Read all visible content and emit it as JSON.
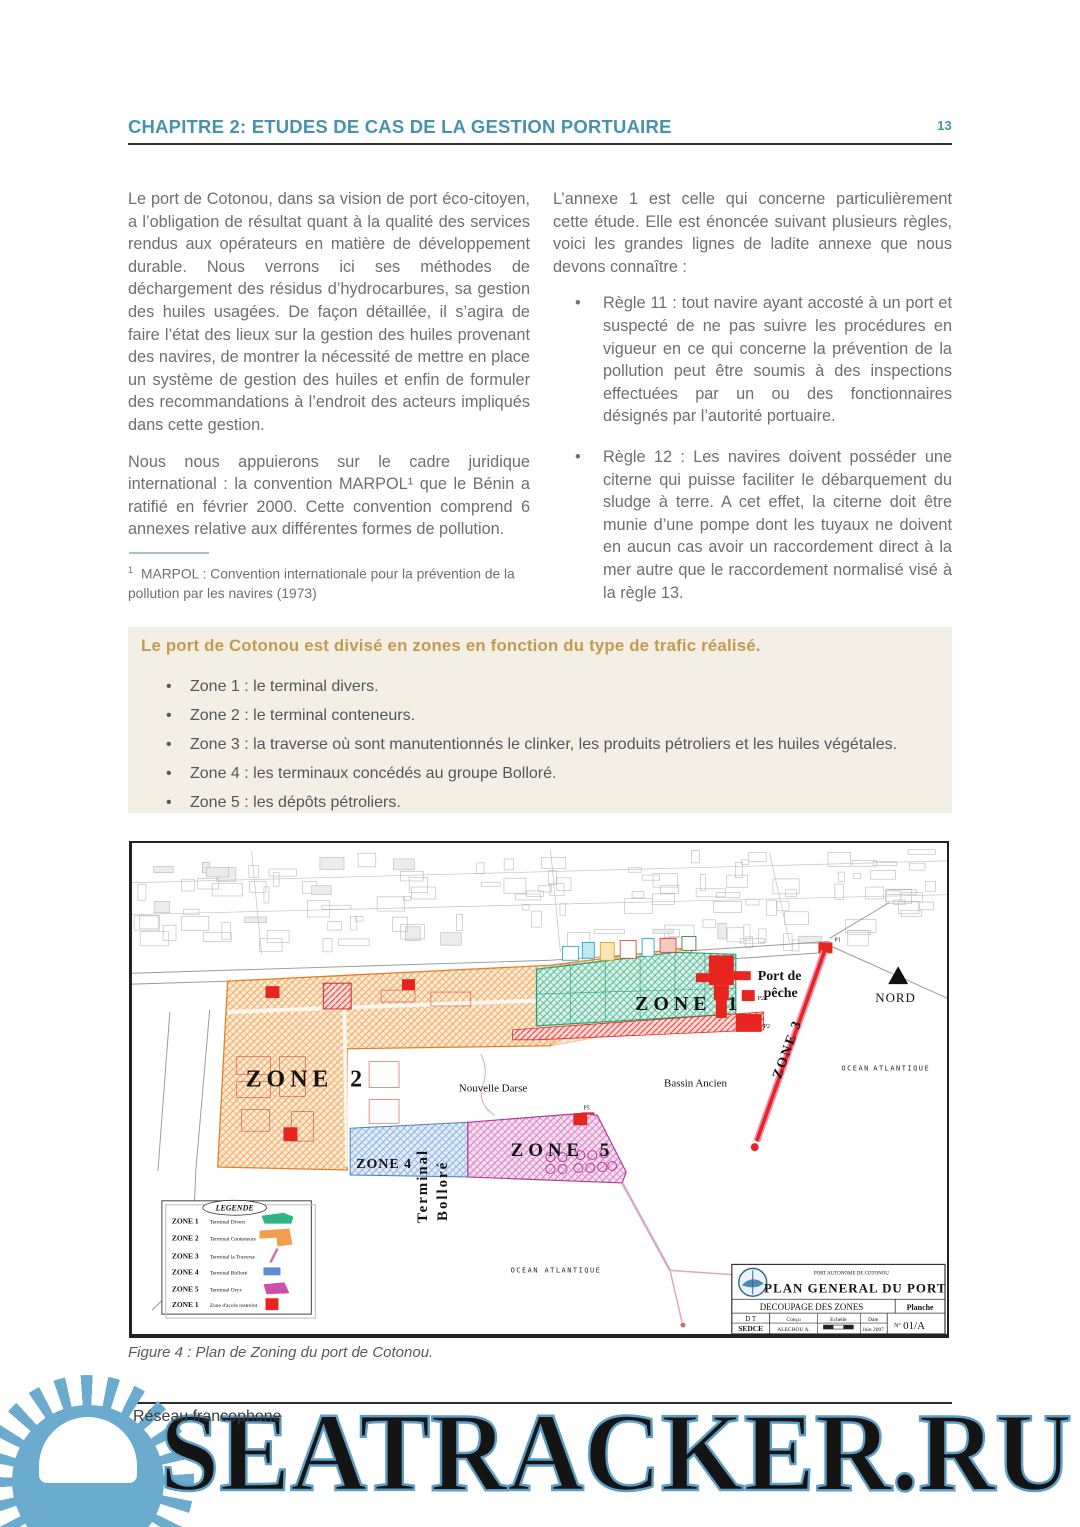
{
  "page": {
    "number": "13"
  },
  "header": {
    "title": "CHAPITRE 2: ETUDES DE CAS DE LA GESTION PORTUAIRE"
  },
  "columns": {
    "left": {
      "p1": "Le port de Cotonou, dans sa vision de port éco-citoyen, a l’obligation de résultat quant à la qualité des services rendus aux opérateurs en matière de développement durable. Nous verrons ici ses méthodes de déchargement des résidus d’hydrocarbures, sa gestion des huiles usagées. De façon détaillée, il s’agira de faire l’état des lieux sur la gestion des huiles provenant des navires, de montrer la nécessité de mettre en place un système de gestion des huiles et enfin de formuler des recommandations à l’endroit des acteurs impliqués dans cette gestion.",
      "p2": "Nous nous appuierons sur le cadre juridique international : la convention MARPOL¹ que le Bénin a ratifié en février 2000. Cette convention comprend 6 annexes relative aux différentes formes de pollution."
    },
    "right": {
      "intro": "L’annexe 1 est celle qui concerne particulièrement cette étude. Elle est énoncée suivant plusieurs règles, voici les grandes lignes de ladite annexe que nous devons connaître :",
      "bullets": [
        "Règle 11 : tout navire ayant accosté à un port et suspecté de ne pas suivre les procédures en vigueur en ce qui concerne la prévention de la pollution peut être soumis à des inspections effectuées par un ou des fonctionnaires désignés par l’autorité portuaire.",
        "Règle 12 : Les navires doivent posséder une citerne qui puisse faciliter le débarquement du sludge à terre. A cet effet, la citerne doit être munie d’une pompe dont les tuyaux ne doivent en aucun cas avoir un raccordement direct à la mer autre que le raccordement normalisé visé à la règle 13."
      ]
    }
  },
  "footnote": {
    "marker": "1",
    "text": "MARPOL : Convention internationale pour la prévention de la pollution par les navires (1973)"
  },
  "zone_box": {
    "title": "Le port de Cotonou est divisé en zones en fonction du type de trafic réalisé.",
    "items": [
      "Zone 1 : le terminal divers.",
      "Zone 2 : le terminal conteneurs.",
      "Zone 3 : la traverse où sont manutentionnés le clinker, les produits pétroliers et les huiles végétales.",
      "Zone 4 : les terminaux concédés au groupe Bolloré.",
      "Zone 5 : les dépôts pétroliers."
    ]
  },
  "figure": {
    "caption": "Figure 4 : Plan de Zoning du port de Cotonou.",
    "map": {
      "zones": {
        "z1": "ZONE 1",
        "z2": "ZONE 2",
        "z3": "ZONE 3",
        "z4": "ZONE 4",
        "z5": "ZONE 5"
      },
      "labels": {
        "port_de_peche_1": "Port de",
        "port_de_peche_2": "pêche",
        "nord": "NORD",
        "ocean_a": "OCEAN",
        "ocean_b": "ATLANTIQUE",
        "nouvelle_darse": "Nouvelle  Darse",
        "bassin_ancien": "Bassin  Ancien",
        "terminal_1": "Terminal",
        "terminal_2": "Bolloré",
        "marker_p2": "P2",
        "marker_p5": "P5",
        "marker_p1": "P1"
      },
      "legend": {
        "title": "LEGENDE",
        "rows": [
          {
            "zone": "ZONE 1",
            "label": "Terminal Divers"
          },
          {
            "zone": "ZONE 2",
            "label": "Terminal Conteneurs"
          },
          {
            "zone": "ZONE 3",
            "label": "Terminal la Traverse"
          },
          {
            "zone": "ZONE 4",
            "label": "Terminal Bolloré"
          },
          {
            "zone": "ZONE 5",
            "label": "Terminal Oryx"
          },
          {
            "zone": "ZONE 1",
            "label": "Zone d'accès restreint"
          }
        ]
      },
      "titleblock": {
        "org": "PORT AUTONOME DE COTONOU",
        "title": "PLAN GENERAL DU PORT",
        "subtitle": "DECOUPAGE DES ZONES",
        "planche": "Planche",
        "dt": "D T",
        "sedce": "SEDCE",
        "concu": "Conçu",
        "author": "ALECHOU A.",
        "echelle": "Echelle",
        "date": "Date",
        "date_value": "Juin 2007",
        "num_prefix": "N°",
        "num": "01/A"
      }
    }
  },
  "footer": {
    "network": "Réseau francophone",
    "watermark": "SEATRACKER.RU"
  },
  "colors": {
    "accent_teal": "#4792ad",
    "gold": "#c49a52",
    "box_bg": "#f4efe4",
    "watermark_blue": "#6aabce",
    "zone1_green": "#2eb487",
    "zone2_orange": "#f49d4e",
    "zone3_red": "#e8241e",
    "zone4_blue": "#5a8fd0",
    "zone5_magenta": "#cc4fae"
  }
}
